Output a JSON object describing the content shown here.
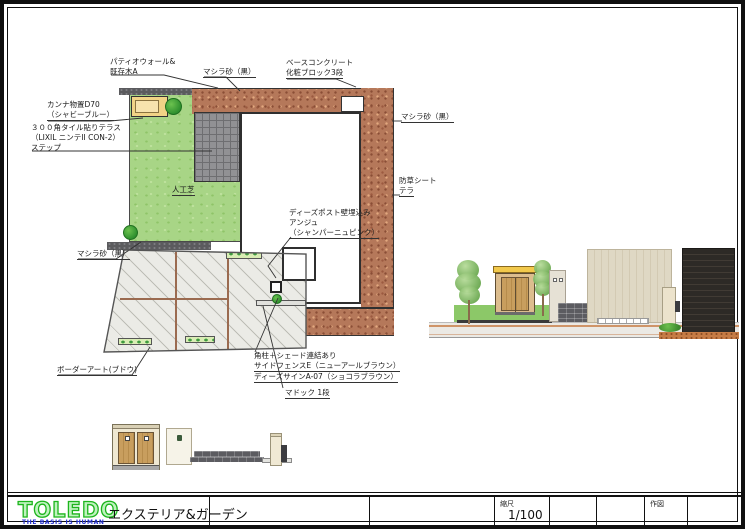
{
  "annotations": [
    {
      "id": "patio-wall",
      "lines": [
        "パティオウォール&",
        "既存木A"
      ]
    },
    {
      "id": "mashira-top",
      "lines": [
        "マシラ砂（黒）"
      ]
    },
    {
      "id": "base-concrete",
      "lines": [
        "ベースコンクリート",
        "化粧ブロック3段"
      ]
    },
    {
      "id": "kanna-shed",
      "lines": [
        "カンナ物置D70",
        "（シャビーブルー）"
      ]
    },
    {
      "id": "tile-terrace",
      "lines": [
        "３００角タイル貼りテラス",
        "（LIXIL ニンテII CON-2）",
        "ステップ"
      ]
    },
    {
      "id": "artificial-turf",
      "lines": [
        "人工芝"
      ]
    },
    {
      "id": "mashira-left",
      "lines": [
        "マシラ砂（黒）"
      ]
    },
    {
      "id": "mashira-right",
      "lines": [
        "マシラ砂（黒）"
      ]
    },
    {
      "id": "weed-sheet",
      "lines": [
        "防草シート",
        "テラ"
      ]
    },
    {
      "id": "dees-post",
      "lines": [
        "ディーズポスト壁埋込み",
        "アンジュ",
        "（シャンパーニュピンク）"
      ]
    },
    {
      "id": "border-art",
      "lines": [
        "ボーダーアート(ブドウ)"
      ]
    },
    {
      "id": "corner-post-fence",
      "lines": [
        "角柱＋シェード連結あり",
        "サイドフェンスE（ニューアールブラウン）",
        "ディーズサインA-07（ショコラブラウン）"
      ]
    },
    {
      "id": "madoc",
      "lines": [
        "マドック 1段"
      ]
    }
  ],
  "footer": {
    "logo": "TOLEDO",
    "tagline": "THE BASIS IS HUMAN",
    "company": "エクステリア&ガーデン",
    "scale_label": "縮尺",
    "scale_value": "1/100",
    "drawn_label": "作図"
  },
  "colors": {
    "logo_green": "#1db51d",
    "tagline_blue": "#2330cf",
    "turf_green": "#a8d586",
    "gravel_brown": "#b5785a"
  }
}
